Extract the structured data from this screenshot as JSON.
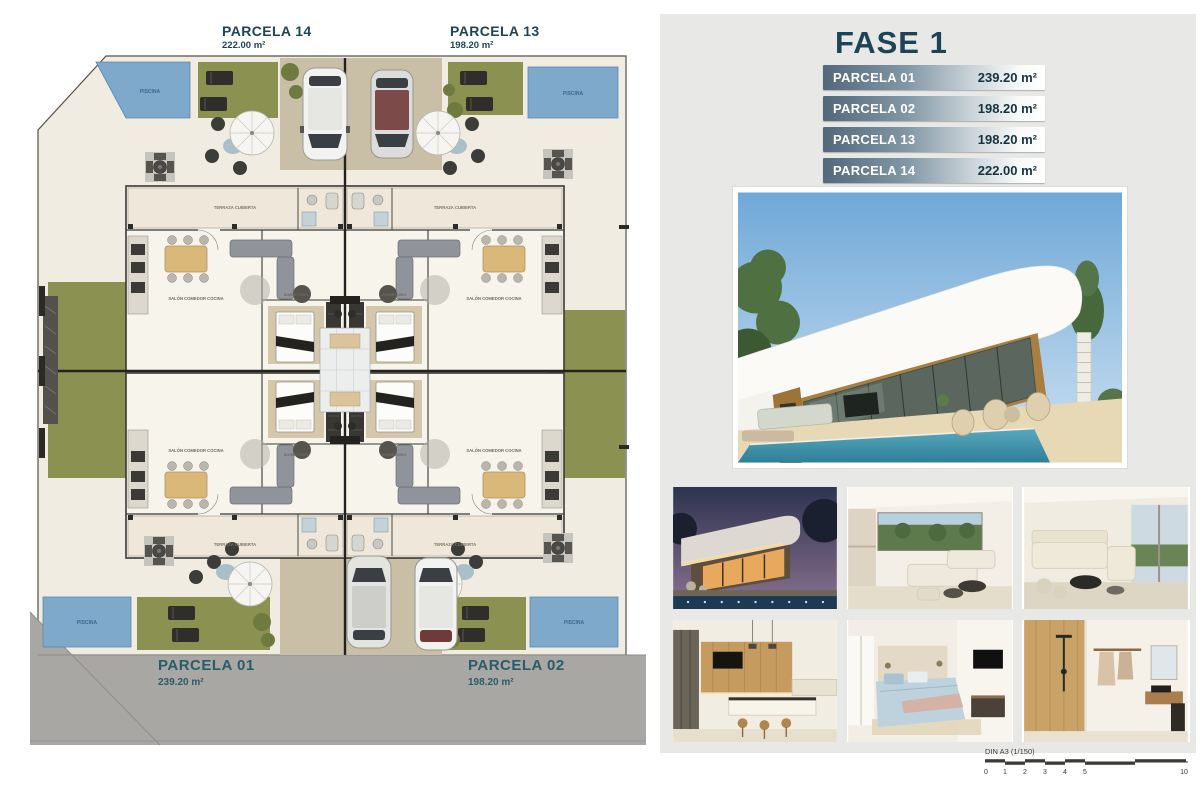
{
  "plan": {
    "top_parcels": [
      {
        "name": "PARCELA 14",
        "area": "222.00 m²"
      },
      {
        "name": "PARCELA 13",
        "area": "198.20 m²"
      }
    ],
    "road_parcels": [
      {
        "name": "PARCELA 01",
        "area": "239.20 m²"
      },
      {
        "name": "PARCELA 02",
        "area": "198.20 m²"
      }
    ],
    "labels": {
      "pool": "PISCINA",
      "terrace": "TERRAZA CUBIERTA",
      "living": "SALÓN COMEDOR COCINA",
      "bedroom": "DORMITORIO"
    }
  },
  "panel": {
    "title": "FASE 1",
    "table": [
      {
        "name": "PARCELA 01",
        "area": "239.20 m²"
      },
      {
        "name": "PARCELA 02",
        "area": "198.20 m²"
      },
      {
        "name": "PARCELA 13",
        "area": "198.20 m²"
      },
      {
        "name": "PARCELA 14",
        "area": "222.00 m²"
      }
    ]
  },
  "scale": {
    "label": "DIN A3 (1/150)",
    "ticks": [
      "0",
      "1",
      "2",
      "3",
      "4",
      "5",
      "10"
    ]
  },
  "colors": {
    "accent_teal": "#1d4557",
    "road_gray": "#a8a7a3",
    "pool_blue": "#7fa9cb",
    "lawn_green": "#8b9150",
    "row_gradient_dark": "#53687b"
  }
}
